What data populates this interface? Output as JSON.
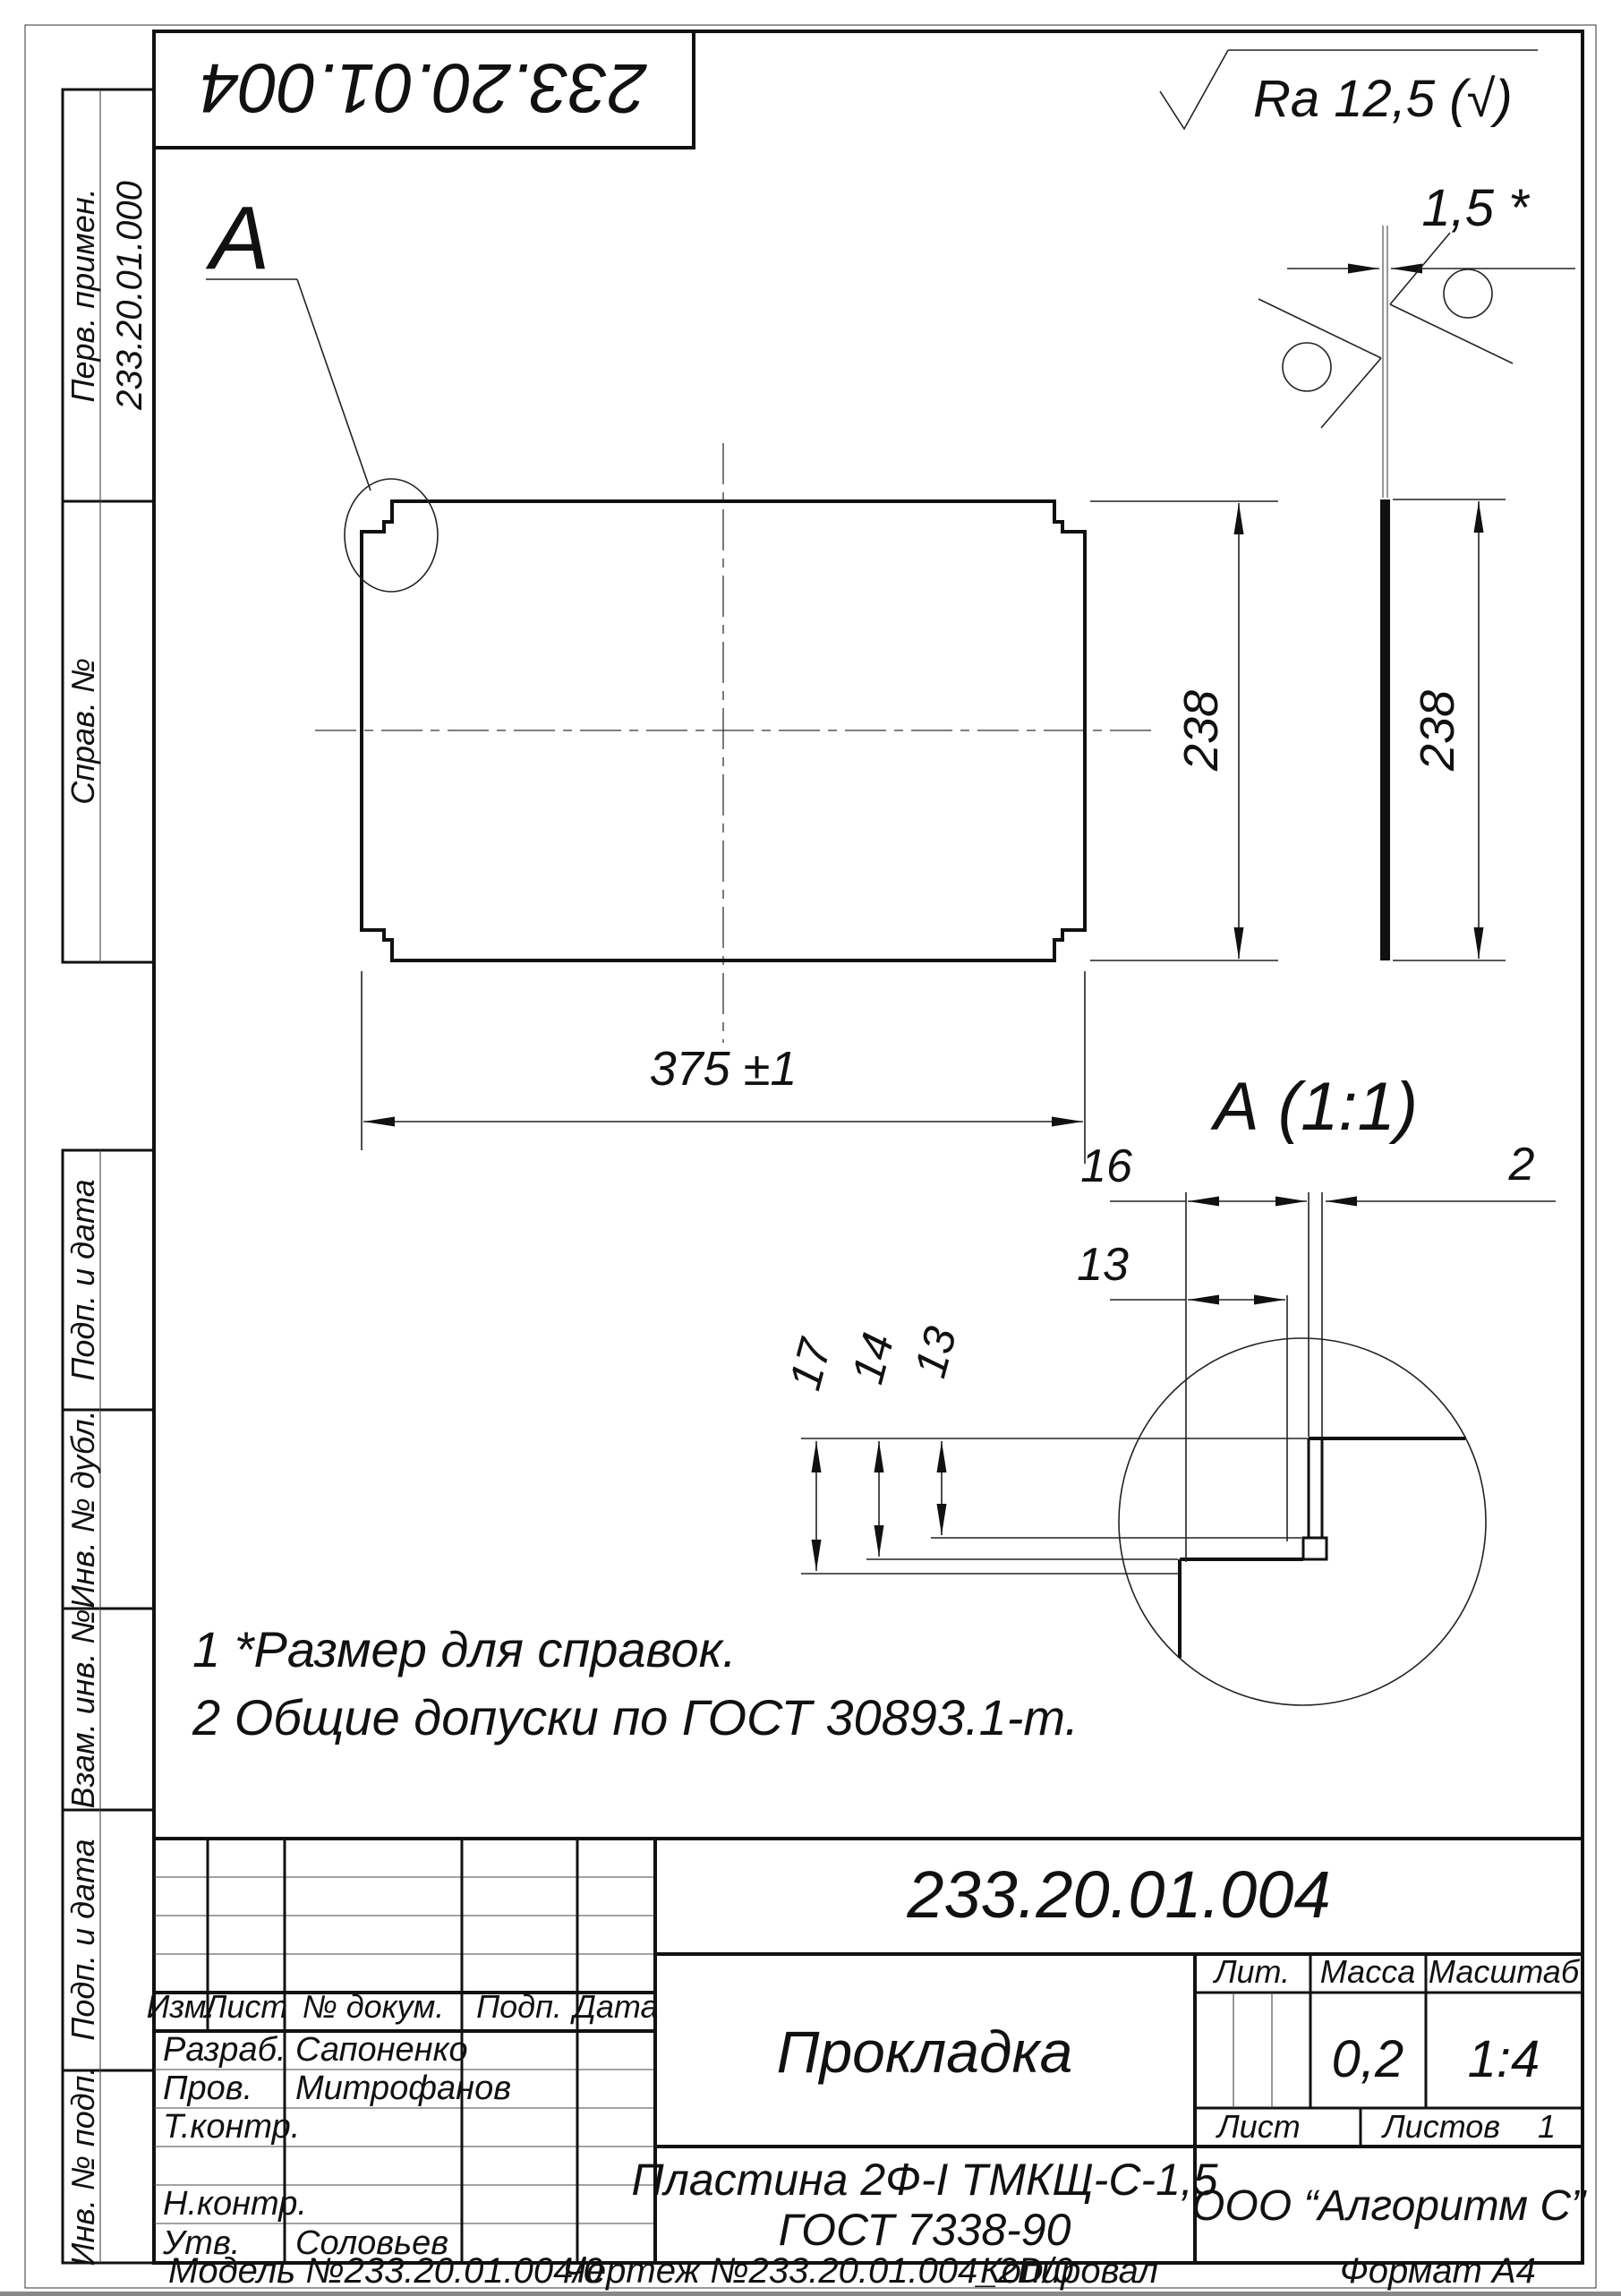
{
  "accent_color": "#111111",
  "margin": {
    "perv_primen": "Перв. примен.",
    "perv_value": "233.20.01.000",
    "sprav": "Справ. №",
    "podp_data_1": "Подп. и дата",
    "inv_dubl": "Инв. № дубл.",
    "vzam_inv": "Взам. инв. №",
    "podp_data_2": "Подп. и дата",
    "inv_podp": "Инв. № подп."
  },
  "top": {
    "rotated_designation": "233.20.01.004",
    "ra_note": "Ra 12,5 (√)"
  },
  "views": {
    "detail_label": "А",
    "detail_title": "А (1:1)",
    "dim_width": "375 ±1",
    "dim_height": "238",
    "side_dim_height": "238",
    "side_thickness": "1,5 *",
    "d16": "16",
    "d13_top": "13",
    "d2": "2",
    "d17": "17",
    "d14": "14",
    "d13_left": "13"
  },
  "notes": {
    "line1": "1 *Размер для справок.",
    "line2": "2 Общие допуски по ГОСТ 30893.1-т."
  },
  "title_block": {
    "designation": "233.20.01.004",
    "name": "Прокладка",
    "material_line1": "Пластина 2Ф-I ТМКЩ-С-1,5",
    "material_line2": "ГОСТ 7338-90",
    "org": "ООО “Алгоритм С”",
    "col_izm": "Изм.",
    "col_list": "Лист",
    "col_doc": "№ докум.",
    "col_podp": "Подп.",
    "col_data": "Дата",
    "razrab_label": "Разраб.",
    "razrab_value": "Сапоненко",
    "prov_label": "Пров.",
    "prov_value": "Митрофанов",
    "tkontr_label": "Т.контр.",
    "nkontr_label": "Н.контр.",
    "utv_label": "Утв.",
    "utv_value": "Соловьев",
    "lit_label": "Лит.",
    "massa_label": "Масса",
    "masshtab_label": "Масштаб",
    "massa_value": "0,2",
    "masshtab_value": "1:4",
    "list_label": "Лист",
    "listov_label": "Листов",
    "listov_value": "1"
  },
  "footer": {
    "model": "Модель №233.20.01.004/0",
    "drawing": "Чертеж №233.20.01.004_2D/0",
    "copied": "Копировал",
    "format": "Формат А4"
  }
}
